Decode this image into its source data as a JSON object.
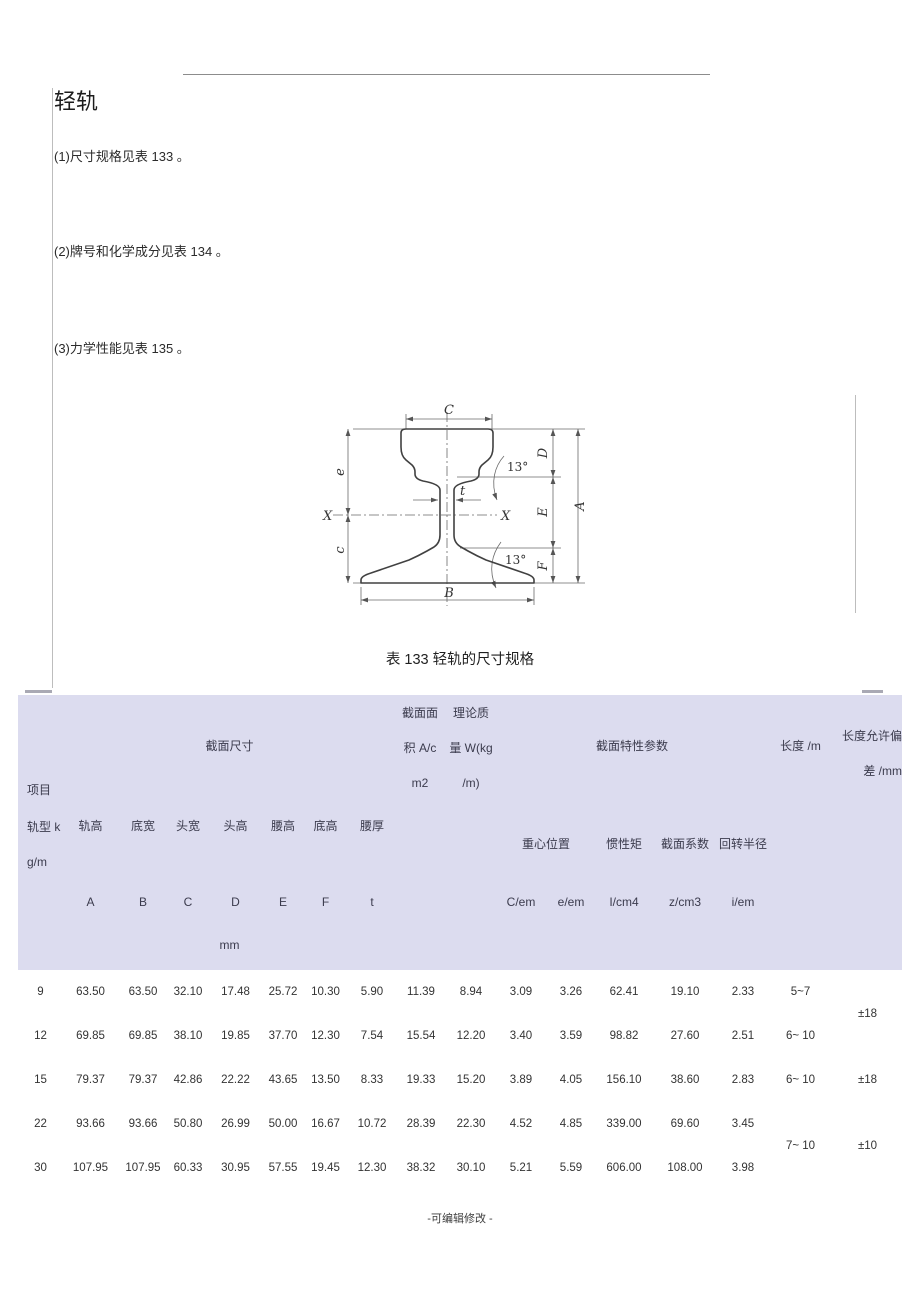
{
  "page": {
    "title": "轻轨",
    "items": [
      {
        "text": "(1)尺寸规格见表 133 。"
      },
      {
        "text": "(2)牌号和化学成分见表 134 。"
      },
      {
        "text": "(3)力学性能见表 135 。"
      }
    ],
    "footer": "-可编辑修改 -"
  },
  "figure": {
    "dim_c_top": "C",
    "dim_d": "D",
    "dim_a": "A",
    "dim_e_right": "E",
    "dim_f": "F",
    "dim_b": "B",
    "dim_e_left": "e",
    "dim_c_left": "c",
    "dim_t": "t",
    "axis_left": "X",
    "axis_right": "X",
    "angle_top": "13°",
    "angle_bottom": "13°"
  },
  "table": {
    "title": "表 133 轻轨的尺寸规格",
    "colors": {
      "header_bg": "#dcdcef"
    },
    "header": {
      "item_label": "项目",
      "rail_type": "轨型 k",
      "rail_type_unit": "g/m",
      "section_dims": "截面尺寸",
      "area_l1": "截面面",
      "area_l2": "积 A/c",
      "area_l3": "m2",
      "mass_l1": "理论质",
      "mass_l2": "量 W(kg",
      "mass_l3": "/m)",
      "section_params": "截面特性参数",
      "length": "长度 /m",
      "tol_l1": "长度允许偏",
      "tol_l2": "差 /mm",
      "centroid": "重心位置",
      "inertia": "惯性矩",
      "modulus": "截面系数",
      "radius": "回转半径",
      "dims": [
        "轨高",
        "底宽",
        "头宽",
        "头高",
        "腰高",
        "底高",
        "腰厚"
      ],
      "letters": [
        "A",
        "B",
        "C",
        "D",
        "E",
        "F",
        "t"
      ],
      "mm": "mm",
      "subcols": [
        "C/em",
        "e/em",
        "I/cm4",
        "z/cm3",
        "i/em"
      ]
    },
    "rows": [
      [
        "9",
        "63.50",
        "63.50",
        "32.10",
        "17.48",
        "25.72",
        "10.30",
        "5.90",
        "11.39",
        "8.94",
        "3.09",
        "3.26",
        "62.41",
        "19.10",
        "2.33",
        "5~7",
        "±18"
      ],
      [
        "12",
        "69.85",
        "69.85",
        "38.10",
        "19.85",
        "37.70",
        "12.30",
        "7.54",
        "15.54",
        "12.20",
        "3.40",
        "3.59",
        "98.82",
        "27.60",
        "2.51",
        "6~ 10"
      ],
      [
        "15",
        "79.37",
        "79.37",
        "42.86",
        "22.22",
        "43.65",
        "13.50",
        "8.33",
        "19.33",
        "15.20",
        "3.89",
        "4.05",
        "156.10",
        "38.60",
        "2.83",
        "6~ 10",
        "±18"
      ],
      [
        "22",
        "93.66",
        "93.66",
        "50.80",
        "26.99",
        "50.00",
        "16.67",
        "10.72",
        "28.39",
        "22.30",
        "4.52",
        "4.85",
        "339.00",
        "69.60",
        "3.45",
        "7~ 10",
        "±10"
      ],
      [
        "30",
        "107.95",
        "107.95",
        "60.33",
        "30.95",
        "57.55",
        "19.45",
        "12.30",
        "38.32",
        "30.10",
        "5.21",
        "5.59",
        "606.00",
        "108.00",
        "3.98"
      ]
    ]
  }
}
